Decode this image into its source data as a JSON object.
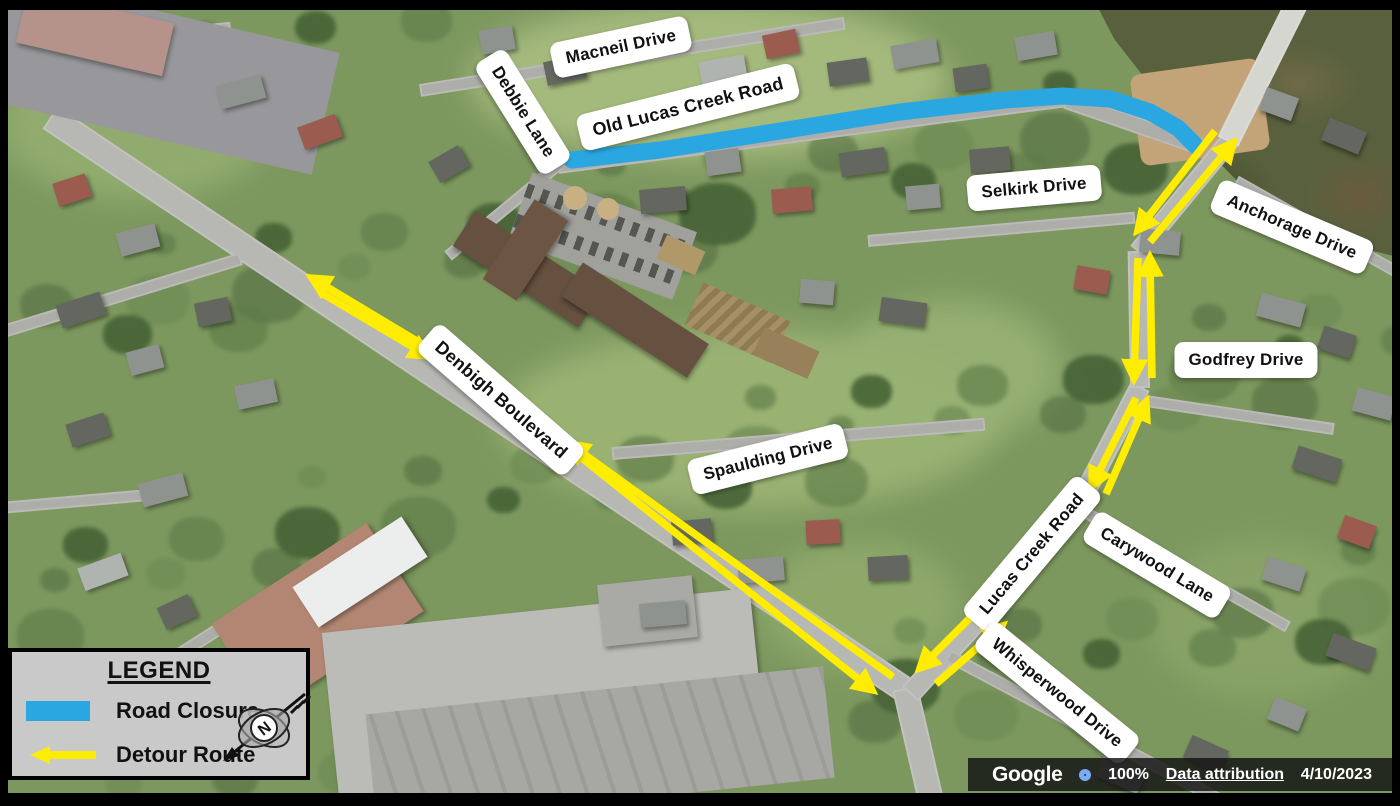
{
  "figure": {
    "type": "road-closure-detour-map"
  },
  "map": {
    "street_labels": [
      {
        "name": "macneil-drive",
        "text": "Macneil Drive"
      },
      {
        "name": "debbie-lane",
        "text": "Debbie Lane"
      },
      {
        "name": "old-lucas-creek-road",
        "text": "Old Lucas Creek Road"
      },
      {
        "name": "selkirk-drive",
        "text": "Selkirk Drive"
      },
      {
        "name": "anchorage-drive",
        "text": "Anchorage Drive"
      },
      {
        "name": "godfrey-drive",
        "text": "Godfrey Drive"
      },
      {
        "name": "denbigh-boulevard",
        "text": "Denbigh Boulevard"
      },
      {
        "name": "spaulding-drive",
        "text": "Spaulding Drive"
      },
      {
        "name": "lucas-creek-road",
        "text": "Lucas Creek Road"
      },
      {
        "name": "carywood-lane",
        "text": "Carywood Lane"
      },
      {
        "name": "whisperwood-drive",
        "text": "Whisperwood Drive"
      }
    ],
    "road_closure_color": "#2aa7e0",
    "detour_route_color": "#ffed00"
  },
  "legend": {
    "title": "LEGEND",
    "items": [
      {
        "label": "Road Closure"
      },
      {
        "label": "Detour Route"
      }
    ],
    "compass_letter": "N"
  },
  "attribution": {
    "brand": "Google",
    "zoom_percent": "100%",
    "data_link": "Data attribution",
    "imagery_date": "4/10/2023"
  }
}
